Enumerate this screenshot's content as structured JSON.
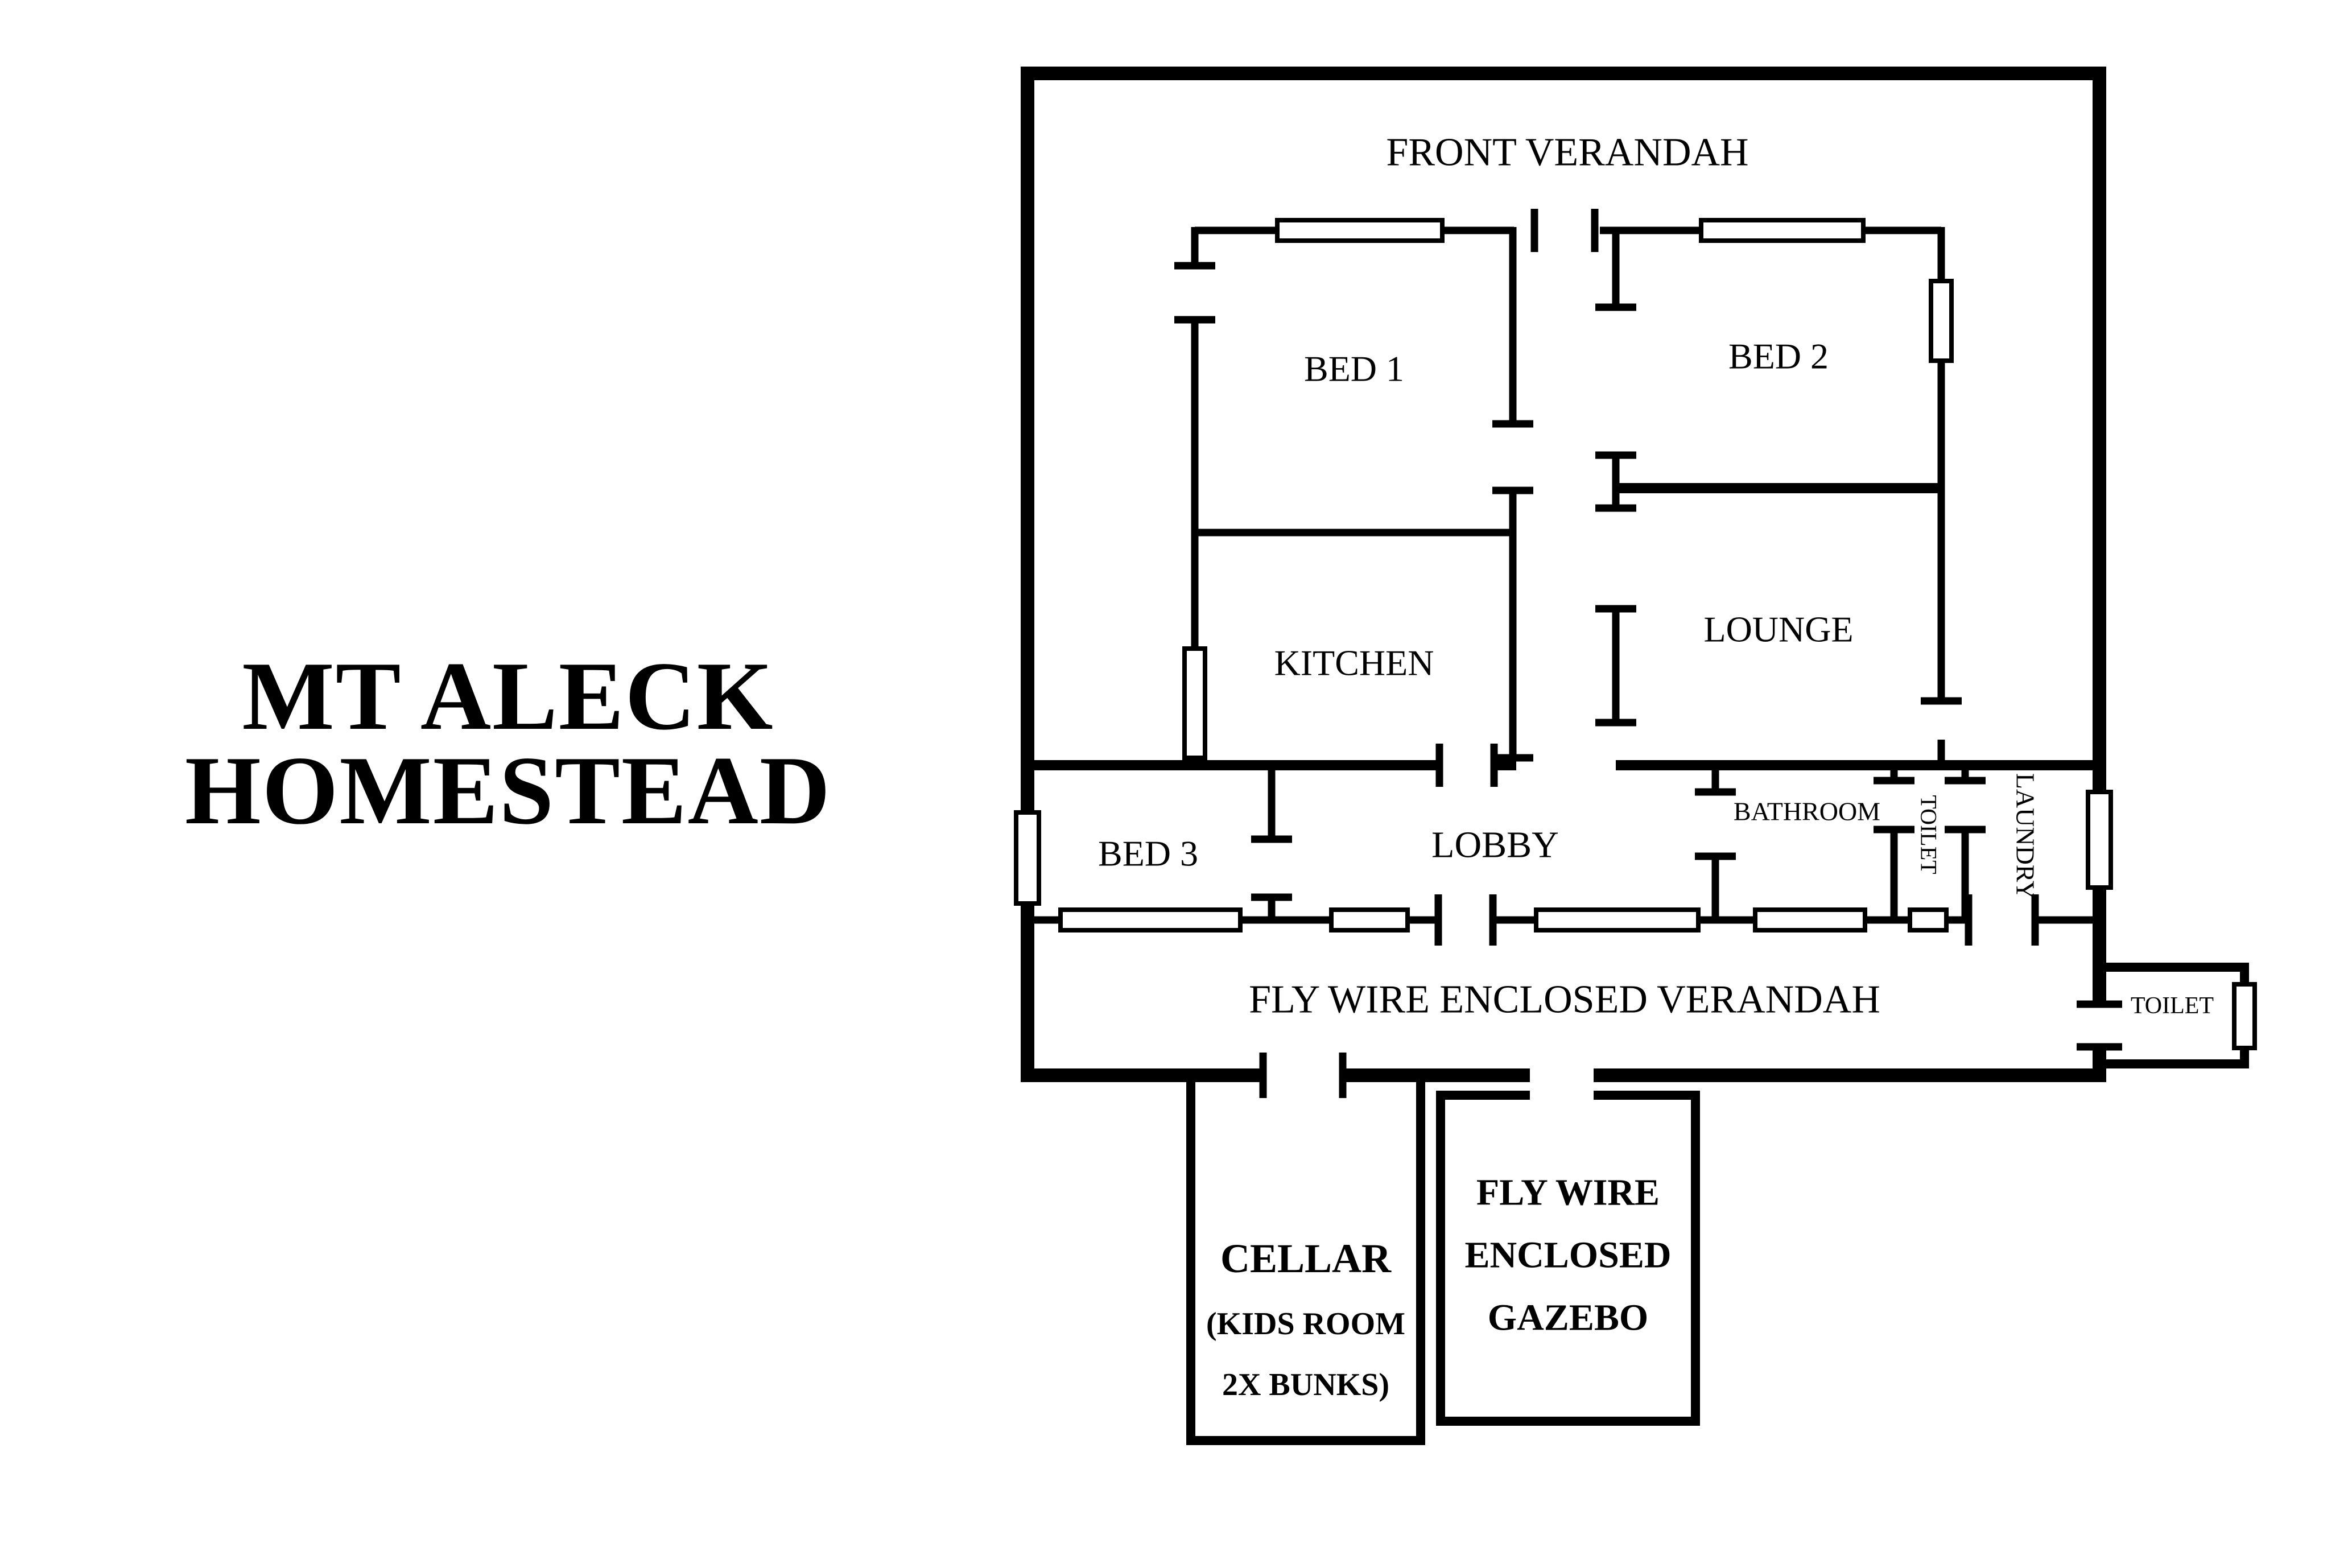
{
  "title": {
    "line1": "MT ALECK",
    "line2": "HOMESTEAD"
  },
  "rooms": {
    "front_verandah": {
      "label": "FRONT VERANDAH"
    },
    "bed1": {
      "label": "BED 1"
    },
    "bed2": {
      "label": "BED 2"
    },
    "kitchen": {
      "label": "KITCHEN"
    },
    "lounge": {
      "label": "LOUNGE"
    },
    "bed3": {
      "label": "BED 3"
    },
    "lobby": {
      "label": "LOBBY"
    },
    "bathroom": {
      "label": "BATHROOM"
    },
    "toilet": {
      "label": "TOILET"
    },
    "laundry": {
      "label": "LAUNDRY"
    },
    "fly_wire_verandah": {
      "label": "FLY WIRE ENCLOSED VERANDAH"
    },
    "outside_toilet": {
      "label": "TOILET"
    },
    "cellar": {
      "lines": [
        "CELLAR",
        "(KIDS ROOM",
        "2X BUNKS)"
      ]
    },
    "gazebo": {
      "lines": [
        "FLY WIRE",
        "ENCLOSED",
        "GAZEBO"
      ]
    }
  },
  "colors": {
    "ink": "#000000",
    "background": "#ffffff"
  }
}
